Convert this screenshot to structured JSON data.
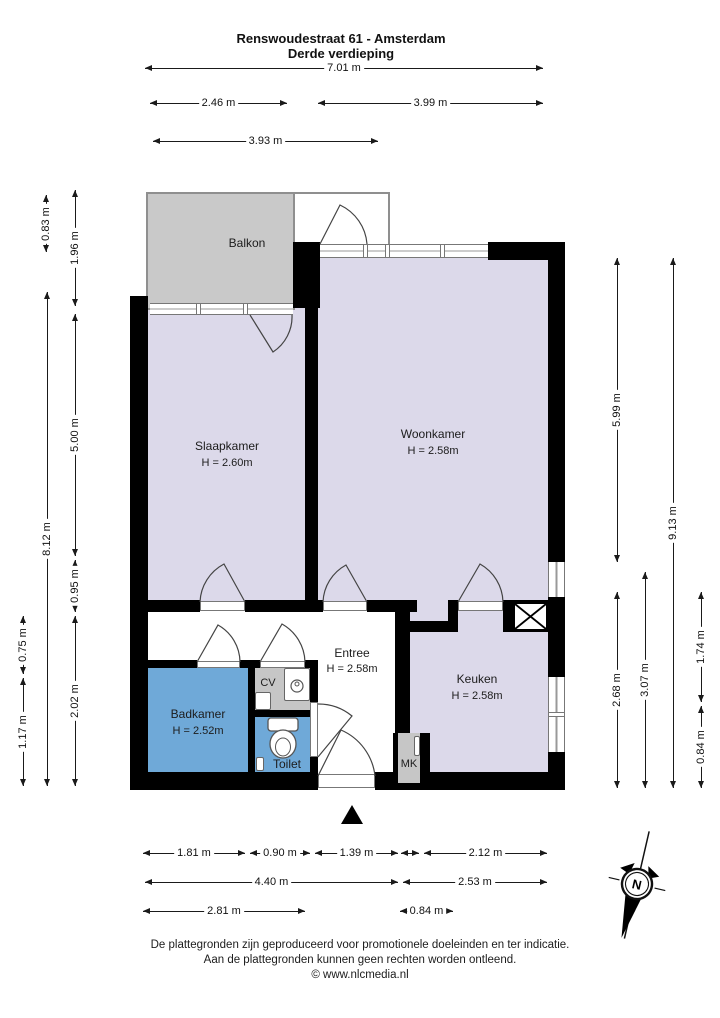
{
  "header": {
    "title": "Renswoudestraat 61 - Amsterdam",
    "subtitle": "Derde verdieping"
  },
  "rooms": {
    "balkon": {
      "name": "Balkon"
    },
    "slaapkamer": {
      "name": "Slaapkamer",
      "ceiling": "H = 2.60m"
    },
    "woonkamer": {
      "name": "Woonkamer",
      "ceiling": "H = 2.58m"
    },
    "entree": {
      "name": "Entree",
      "ceiling": "H = 2.58m"
    },
    "keuken": {
      "name": "Keuken",
      "ceiling": "H = 2.58m"
    },
    "badkamer": {
      "name": "Badkamer",
      "ceiling": "H = 2.52m"
    },
    "toilet": {
      "name": "Toilet"
    },
    "cv": {
      "name": "CV"
    },
    "mk": {
      "name": "MK"
    }
  },
  "dims": {
    "t0": "7.01 m",
    "t1": "2.46 m",
    "t2": "3.99 m",
    "t3": "3.93 m",
    "l0": "0.83 m",
    "l1": "1.96 m",
    "l2": "8.12 m",
    "l3": "5.00 m",
    "l4": "0.95 m",
    "l5": "2.02 m",
    "l6": "0.75 m",
    "l7": "1.17 m",
    "r0": "5.99 m",
    "r1": "9.13 m",
    "r2": "2.68 m",
    "r3": "3.07 m",
    "r4": "1.74 m",
    "r5": "0.84 m",
    "b0": "1.81 m",
    "b1": "0.90 m",
    "b2": "1.39 m",
    "b3": "2.12 m",
    "b4": "4.40 m",
    "b5": "2.53 m",
    "b6": "2.81 m",
    "b7": "0.84 m"
  },
  "compass": {
    "n": "N"
  },
  "footer": {
    "line1": "De plattegronden zijn geproduceerd voor promotionele doeleinden en ter indicatie.",
    "line2": "Aan de plattegronden kunnen geen rechten worden ontleend.",
    "line3": "© www.nlcmedia.nl"
  },
  "colors": {
    "wall": "#000000",
    "room_fill": "#dcd9ea",
    "wet_room_fill": "#6fa9d8",
    "balcony_fill": "#c9c9c9",
    "closet_fill": "#c6c6c6",
    "frame": "#777777"
  }
}
